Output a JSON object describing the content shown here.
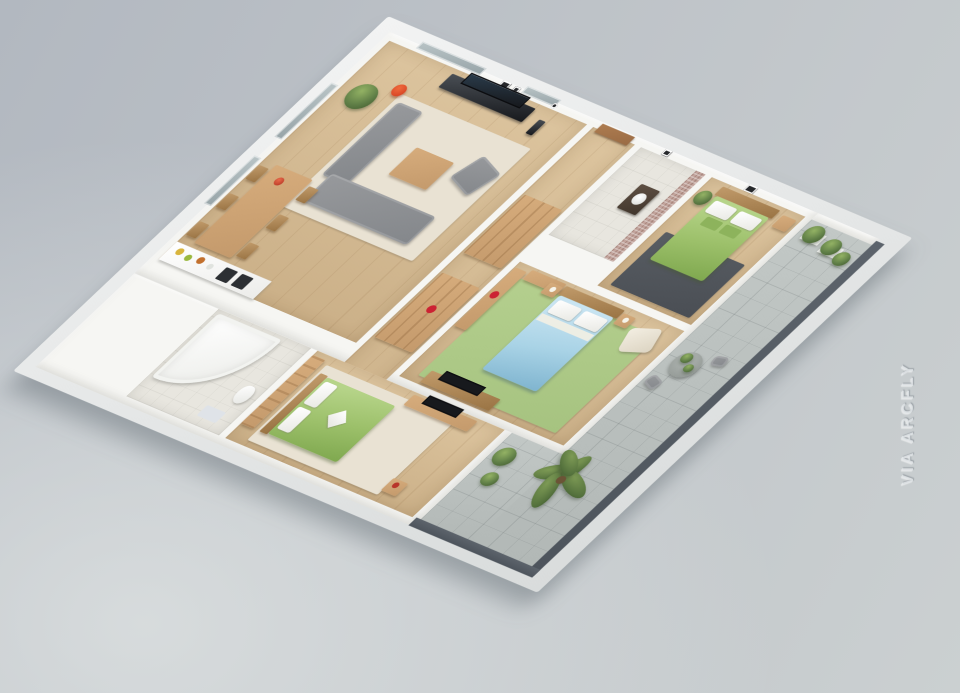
{
  "watermark": {
    "text": "VIA ARCFLY"
  },
  "palette": {
    "wall": "#f6f6f3",
    "wood_floor": "#dcc49e",
    "wood_floor_dark": "#cbb088",
    "wood_furniture": "#c49a6c",
    "sofa": "#84878b",
    "rug_cream": "#e9e2d3",
    "rug_green": "#a6c380",
    "rug_dark": "#4a4e54",
    "bed_green": "#9cc06a",
    "bed_blue": "#a9d3e6",
    "accent_red": "#d03a1e",
    "plant": "#5e7d46",
    "tile": "#e8e6df",
    "balcony_floor": "#b2b8b6",
    "parapet": "#4d545c",
    "door_brown": "#9a6b44",
    "mosaic": "#c2a49c",
    "tv_dark": "#17191d",
    "background_top": "#b2b8c0",
    "background_bottom": "#cbd0d1"
  },
  "scene": {
    "type": "3d-isometric-floor-plan-render",
    "subject": "three-bedroom apartment cutaway model",
    "rooms": [
      {
        "name": "living-room",
        "furniture": [
          "corner-sofa",
          "armchair",
          "coffee-table",
          "tv-console",
          "wall-tv",
          "red-floor-lamp",
          "potted-plant",
          "cream-rug",
          "wall-art",
          "wall-clock"
        ]
      },
      {
        "name": "dining-area",
        "furniture": [
          "wooden-dining-table",
          "six-chairs",
          "red-table-plant"
        ]
      },
      {
        "name": "kitchen",
        "furniture": [
          "white-counter",
          "dark-cooktops",
          "food-items"
        ]
      },
      {
        "name": "family-bathroom",
        "furniture": [
          "corner-bathtub",
          "toilet",
          "white-tile-floor"
        ]
      },
      {
        "name": "hallway",
        "furniture": [
          "entry-door",
          "wooden-wardrobes",
          "red-clothes"
        ]
      },
      {
        "name": "ensuite-bathroom",
        "furniture": [
          "sink-vanity",
          "mosaic-tile-wall"
        ]
      },
      {
        "name": "bedroom-top",
        "furniture": [
          "green-double-bed",
          "dark-gray-rug",
          "nightstand",
          "potted-plant",
          "wall-art"
        ]
      },
      {
        "name": "master-bedroom",
        "furniture": [
          "blue-double-bed",
          "green-rug",
          "open-wardrobe",
          "nightstands",
          "cream-armchair",
          "tv-console"
        ]
      },
      {
        "name": "bedroom-bottom",
        "furniture": [
          "green-double-bed",
          "cream-rug",
          "tv-sideboard",
          "wardrobe-partition",
          "side-table"
        ]
      },
      {
        "name": "balcony-terrace",
        "furniture": [
          "round-table",
          "chairs",
          "potted-plants",
          "planter-boxes",
          "palm-tree",
          "dark-parapet"
        ]
      }
    ]
  }
}
